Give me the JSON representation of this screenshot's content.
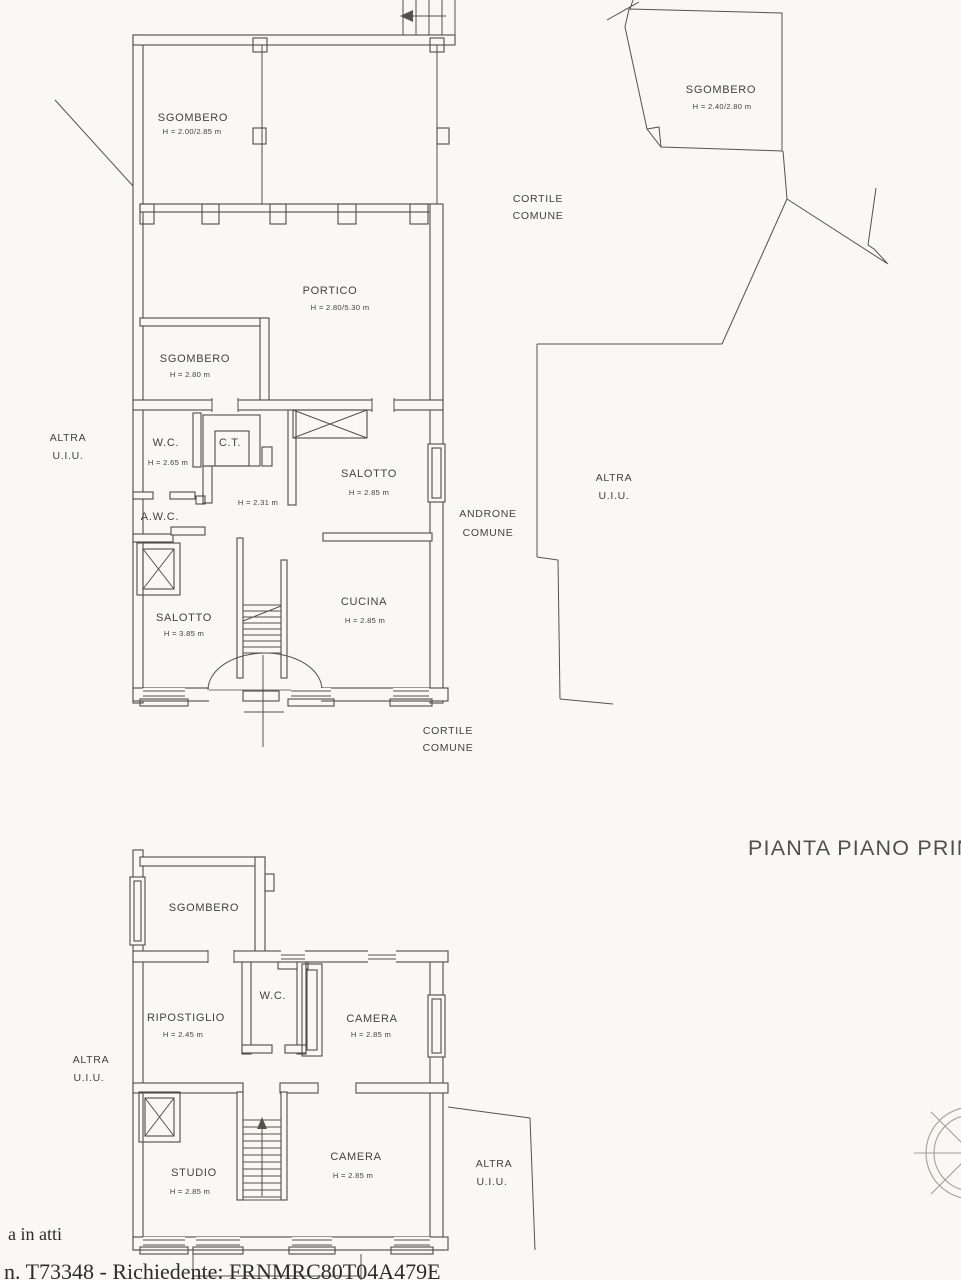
{
  "title": {
    "text": "PIANTA PIANO PRIMO"
  },
  "ground_floor": {
    "sgombero_top": {
      "name": "SGOMBERO",
      "height": "H = 2.00/2.85 m"
    },
    "sgombero_annex": {
      "name": "SGOMBERO",
      "height": "H = 2.40/2.80 m"
    },
    "cortile_top": {
      "line1": "CORTILE",
      "line2": "COMUNE"
    },
    "portico": {
      "name": "PORTICO",
      "height": "H = 2.80/5.30 m"
    },
    "sgombero_mid": {
      "name": "SGOMBERO",
      "height": "H = 2.80 m"
    },
    "wc": {
      "name": "W.C.",
      "height": "H = 2.65 m"
    },
    "ct": {
      "name": "C.T."
    },
    "awc": {
      "name": "A.W.C."
    },
    "hall_height": "H = 2.31 m",
    "salotto_upper": {
      "name": "SALOTTO",
      "height": "H = 2.85 m"
    },
    "androne": {
      "line1": "ANDRONE",
      "line2": "COMUNE"
    },
    "altra_uiu_left": {
      "line1": "ALTRA",
      "line2": "U.I.U."
    },
    "altra_uiu_right": {
      "line1": "ALTRA",
      "line2": "U.I.U."
    },
    "salotto_lower": {
      "name": "SALOTTO",
      "height": "H = 3.85 m"
    },
    "cucina": {
      "name": "CUCINA",
      "height": "H = 2.85 m"
    },
    "cortile_bottom": {
      "line1": "CORTILE",
      "line2": "COMUNE"
    }
  },
  "first_floor": {
    "sgombero": {
      "name": "SGOMBERO"
    },
    "ripostiglio": {
      "name": "RIPOSTIGLIO",
      "height": "H = 2.45 m"
    },
    "wc": {
      "name": "W.C."
    },
    "camera_upper": {
      "name": "CAMERA",
      "height": "H = 2.85 m"
    },
    "altra_uiu_left": {
      "line1": "ALTRA",
      "line2": "U.I.U."
    },
    "studio": {
      "name": "STUDIO",
      "height": "H = 2.85 m"
    },
    "camera_lower": {
      "name": "CAMERA",
      "height": "H = 2.85 m"
    },
    "altra_uiu_right": {
      "line1": "ALTRA",
      "line2": "U.I.U."
    }
  },
  "footer": {
    "note": "a in atti",
    "reference": "n. T73348 - Richiedente: FRNMRC80T04A479E"
  }
}
